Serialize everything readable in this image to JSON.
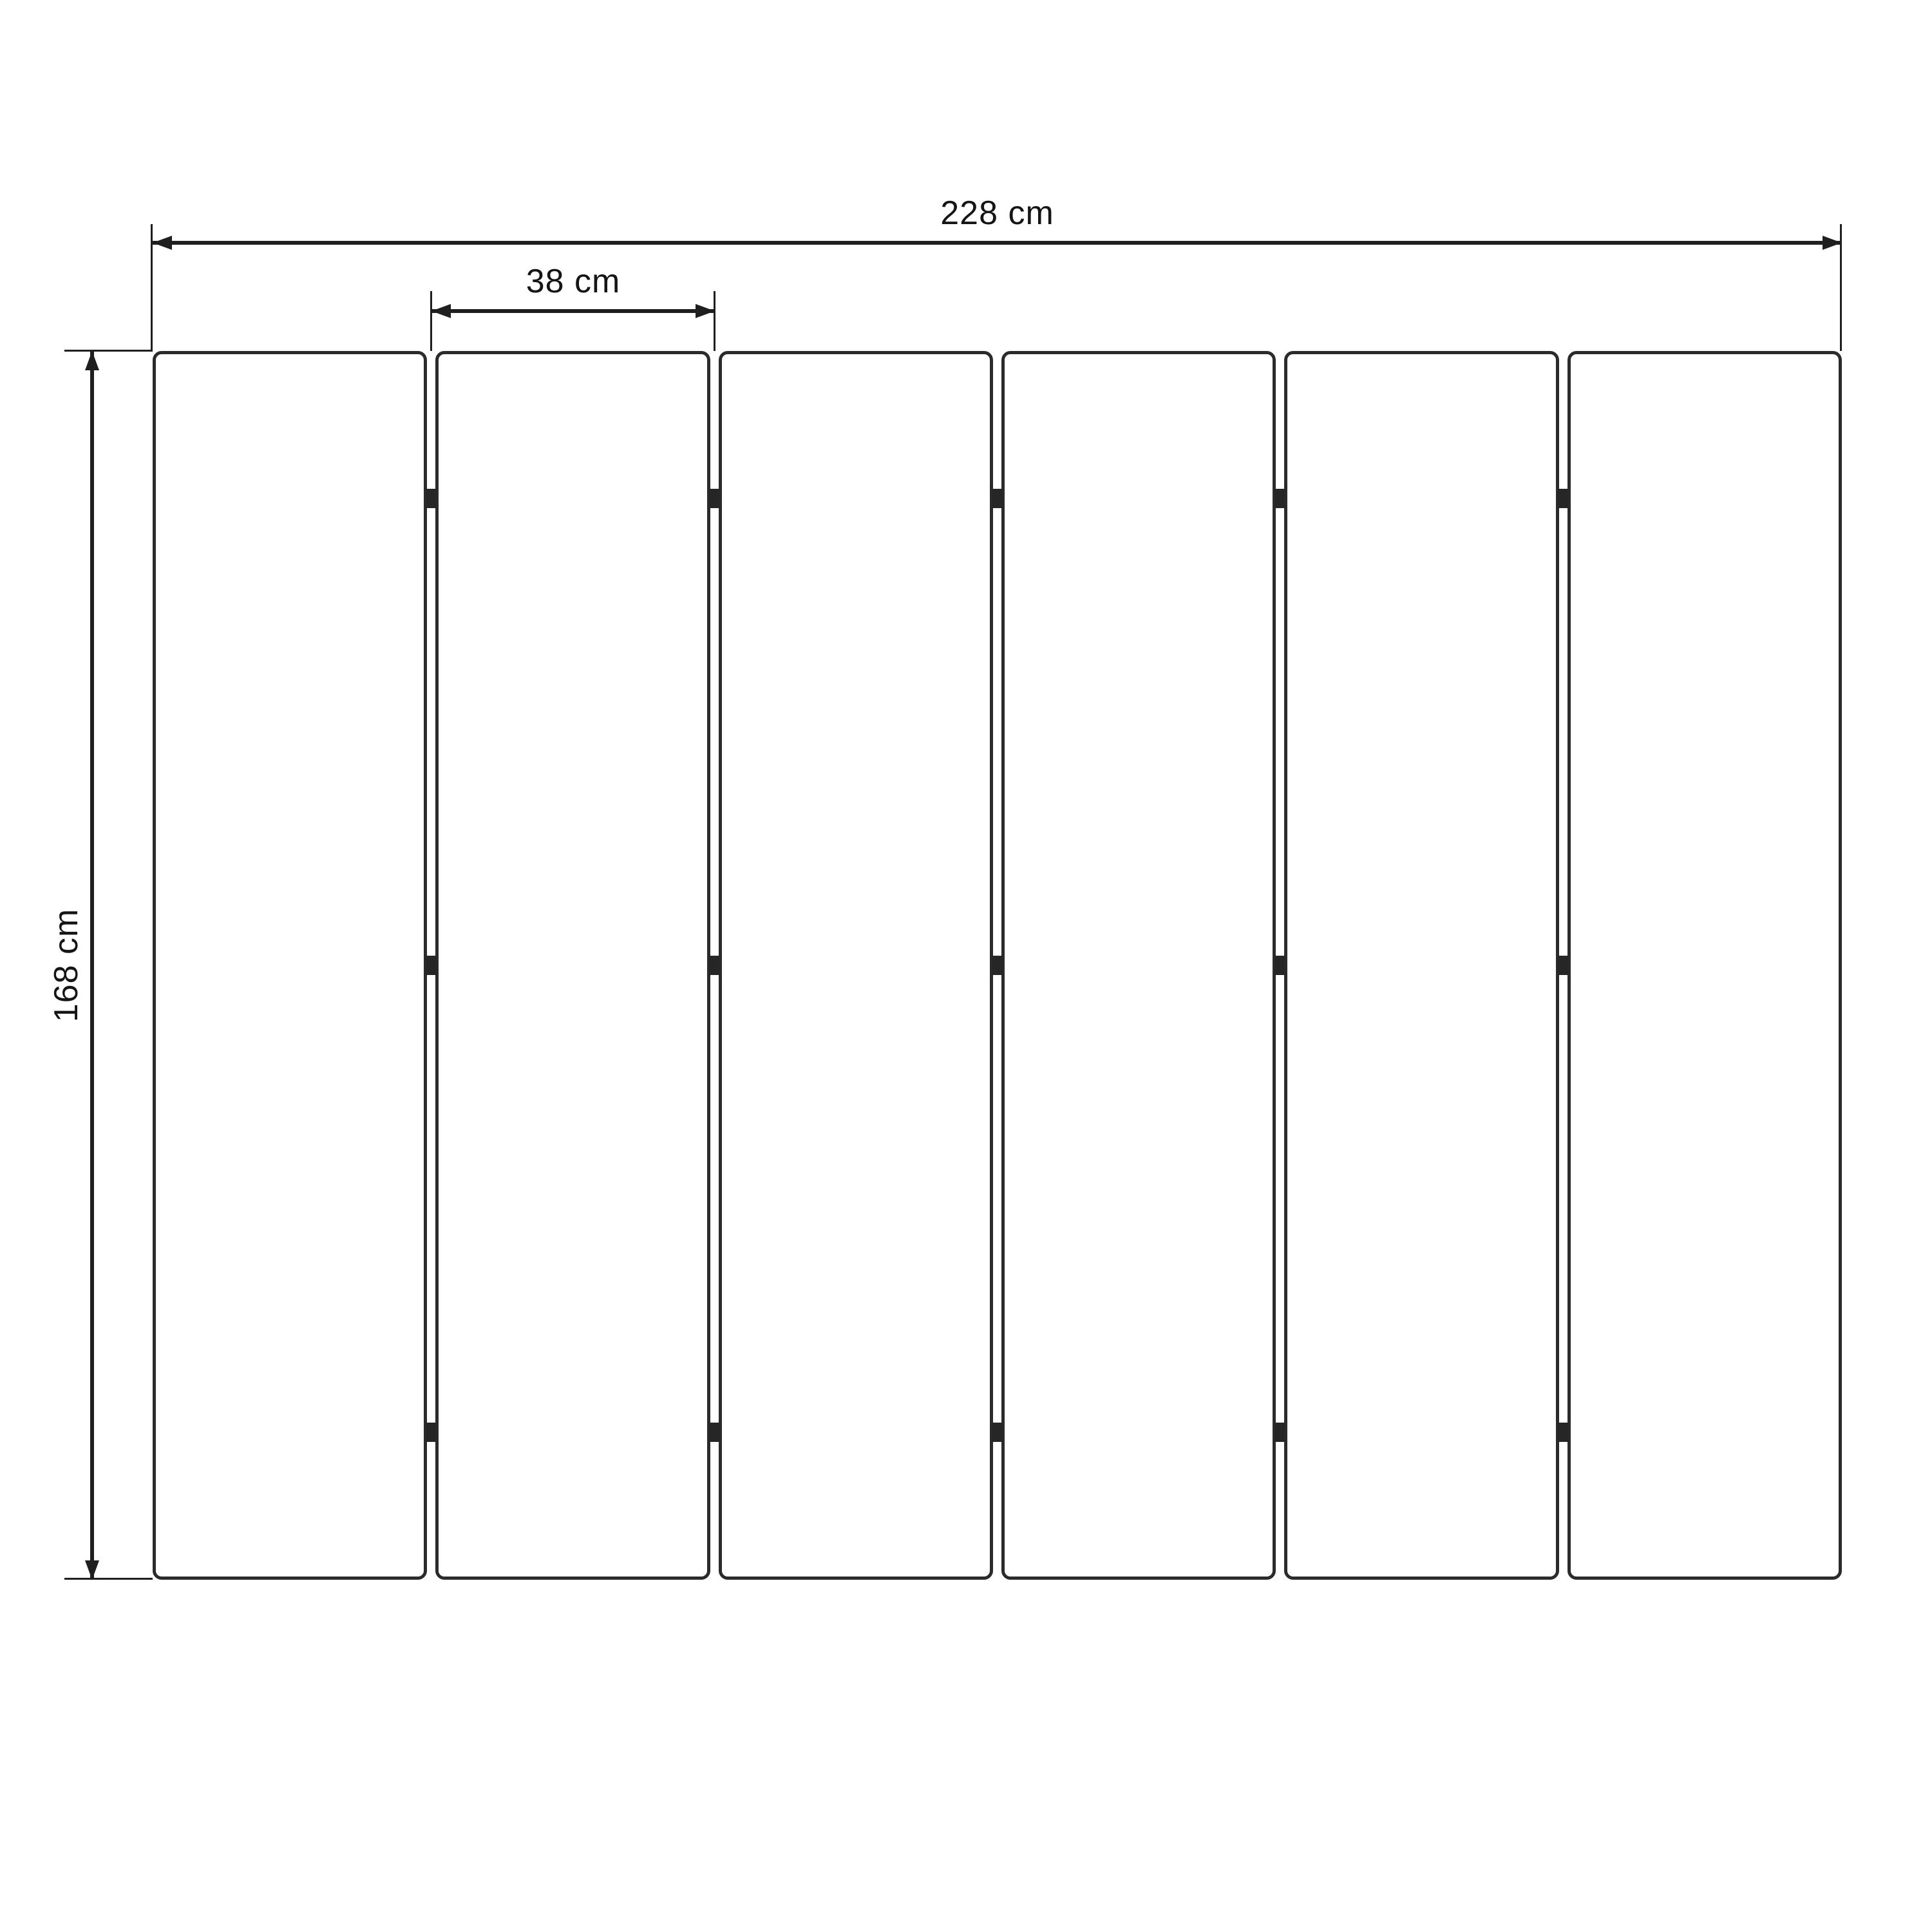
{
  "diagram": {
    "type": "folding-screen-dimension-drawing",
    "background": "#ffffff",
    "line_color": "#1f1f1f",
    "panel_border_color": "#2b2b2b",
    "hinge_color": "#262626",
    "panel_count": 6,
    "hinges_per_joint": 3,
    "hinge_row_fractions": [
      0.12,
      0.5,
      0.88
    ],
    "dimensions": {
      "total_width": {
        "label": "228 cm"
      },
      "panel_width": {
        "label": "38 cm"
      },
      "height": {
        "label": "168 cm"
      }
    }
  }
}
